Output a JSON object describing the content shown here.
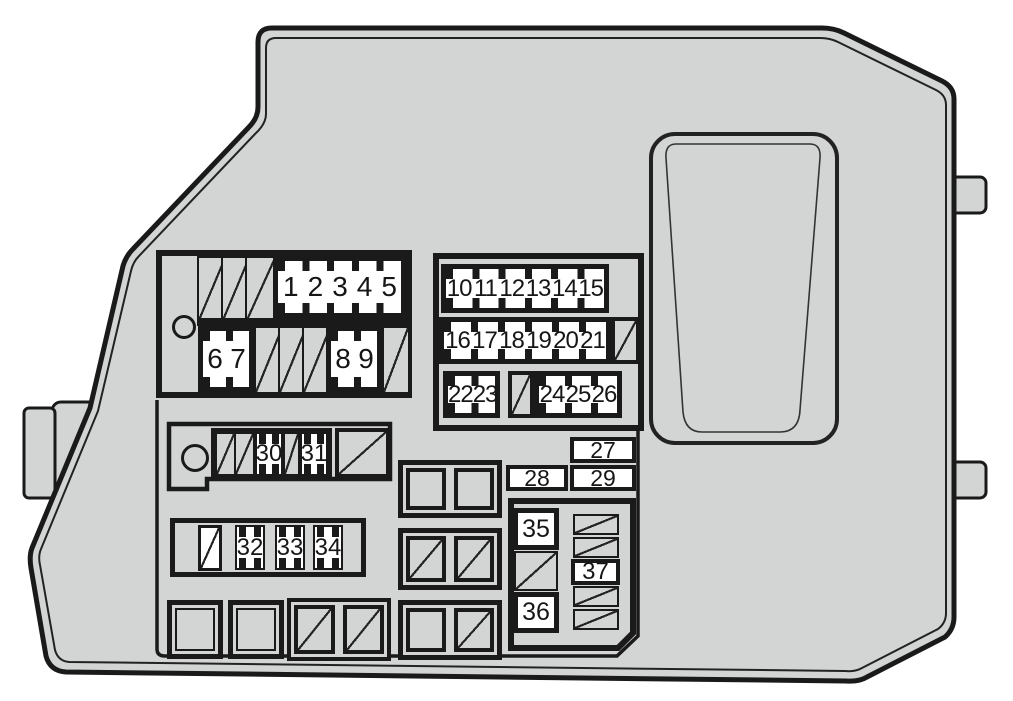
{
  "diagram": {
    "type": "engine-compartment-fuse-box-cover-diagram",
    "colors": {
      "cover": "#d3d5d4",
      "outline": "#1a1a1a",
      "fuse_fill": "#ffffff"
    },
    "fuses": {
      "f1_5": [
        "1",
        "2",
        "3",
        "4",
        "5"
      ],
      "f6_7": [
        "6",
        "7"
      ],
      "f8_9": [
        "8",
        "9"
      ],
      "f10_15": [
        "10",
        "11",
        "12",
        "13",
        "14",
        "15"
      ],
      "f16_21": [
        "16",
        "17",
        "18",
        "19",
        "20",
        "21"
      ],
      "f22_23": [
        "22",
        "23"
      ],
      "f24_26": [
        "24",
        "25",
        "26"
      ],
      "f27": "27",
      "f28": "28",
      "f29": "29",
      "f30": "30",
      "f31": "31",
      "f32_34": [
        "32",
        "33",
        "34"
      ],
      "f35": "35",
      "f36": "36",
      "f37": "37"
    }
  }
}
